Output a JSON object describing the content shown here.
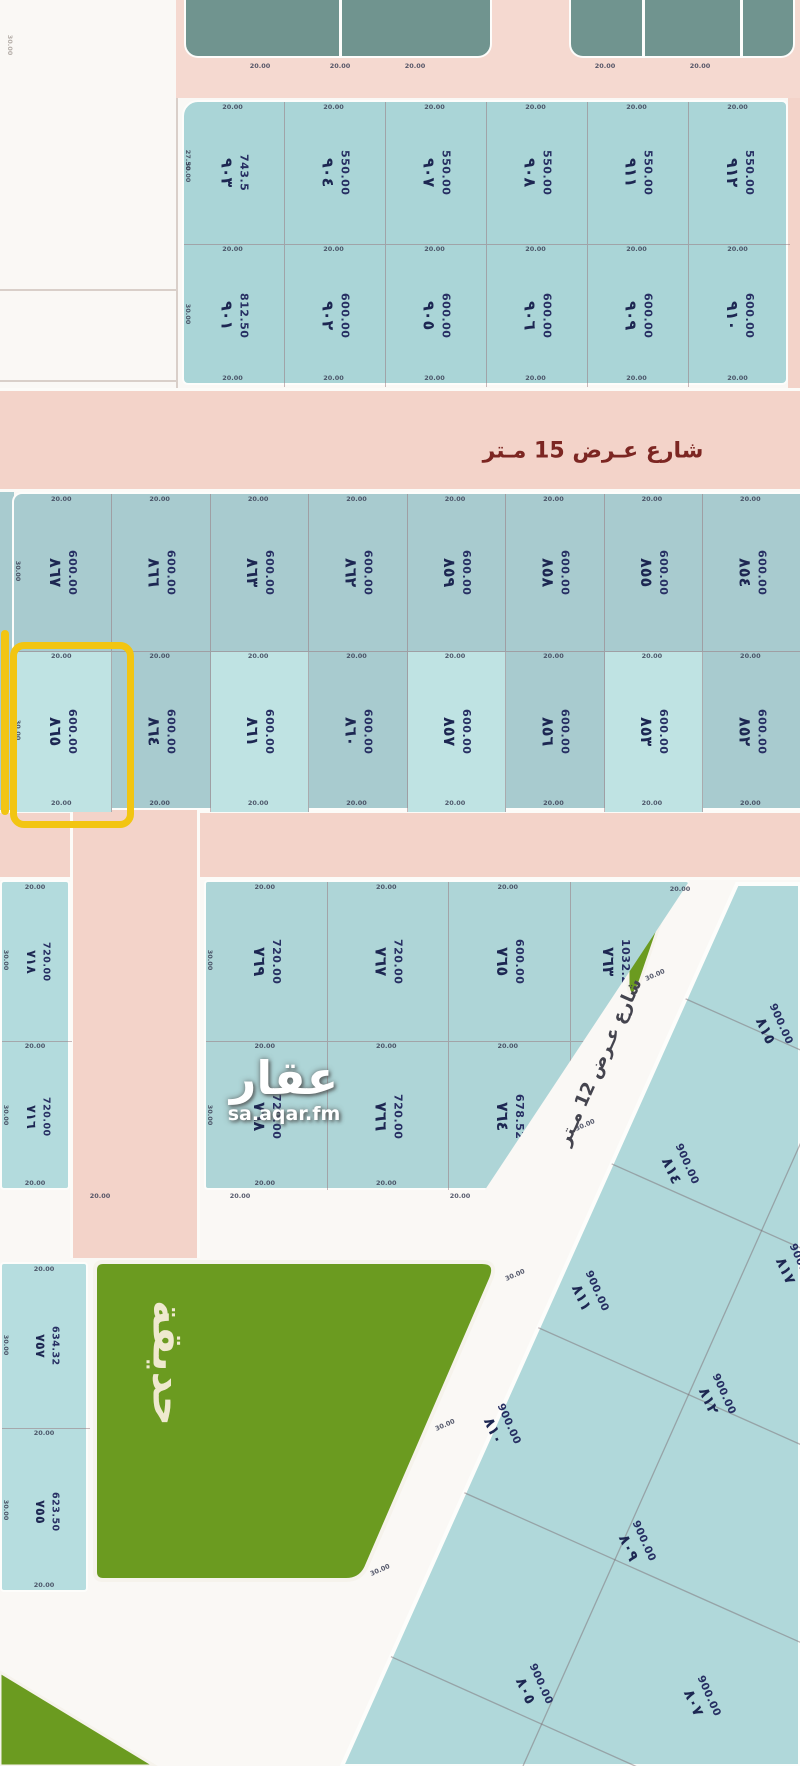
{
  "colors": {
    "road_pink": "#f3d3c9",
    "plot_teal": "#a9ced2",
    "plot_teal_light": "#c0e4e4",
    "dark_block": "#70948f",
    "garden_green": "#6b9b20",
    "number_ink": "#1d2752",
    "street_label_ink": "#7c2622",
    "highlight_yellow": "#f2c512",
    "watermark_white": "#ffffff"
  },
  "streets": {
    "street15_label": "شارع عـرض 15 مـتر",
    "street12_label": "شارع عـرض 12 مـتر"
  },
  "garden": {
    "label": "حديقة"
  },
  "watermark": {
    "logo": "عقار",
    "site": "sa.aqar.fm"
  },
  "dims": {
    "h": "20.00",
    "v": "30.00",
    "v1": "27.50"
  },
  "highlight": {
    "highlighted_plot_number": "٨٦٥"
  },
  "blocks": {
    "north_block_rows": [
      [
        {
          "n": "٩٠٣",
          "a": "743.5"
        },
        {
          "n": "٩٠٤",
          "a": "550.00"
        },
        {
          "n": "٩٠٧",
          "a": "550.00"
        },
        {
          "n": "٩٠٨",
          "a": "550.00"
        },
        {
          "n": "٩١١",
          "a": "550.00"
        },
        {
          "n": "٩١٢",
          "a": "550.00"
        }
      ],
      [
        {
          "n": "٩٠١",
          "a": "812.50"
        },
        {
          "n": "٩٠٢",
          "a": "600.00"
        },
        {
          "n": "٩٠٥",
          "a": "600.00"
        },
        {
          "n": "٩٠٦",
          "a": "600.00"
        },
        {
          "n": "٩٠٩",
          "a": "600.00"
        },
        {
          "n": "٩١٠",
          "a": "600.00"
        }
      ]
    ],
    "mid_block_rows": [
      [
        {
          "n": "٨٦٧",
          "a": "600.00"
        },
        {
          "n": "٨٦٦",
          "a": "600.00"
        },
        {
          "n": "٨٦٣",
          "a": "600.00"
        },
        {
          "n": "٨٦٢",
          "a": "600.00"
        },
        {
          "n": "٨٥٩",
          "a": "600.00"
        },
        {
          "n": "٨٥٨",
          "a": "600.00"
        },
        {
          "n": "٨٥٥",
          "a": "600.00"
        },
        {
          "n": "٨٥٤",
          "a": "600.00"
        },
        {
          "n": "٨٥١",
          "a": "600.00"
        }
      ],
      [
        {
          "n": "٨٦٥",
          "a": "600.00"
        },
        {
          "n": "٨٦٤",
          "a": "600.00"
        },
        {
          "n": "٨٦١",
          "a": "600.00"
        },
        {
          "n": "٨٦٠",
          "a": "600.00"
        },
        {
          "n": "٨٥٧",
          "a": "600.00"
        },
        {
          "n": "٨٥٦",
          "a": "600.00"
        },
        {
          "n": "٨٥٣",
          "a": "600.00"
        },
        {
          "n": "٨٥٢",
          "a": "600.00"
        },
        {
          "n": "٨٤٩",
          "a": "600.00"
        }
      ]
    ],
    "south_block_rows": [
      [
        {
          "n": "٧٦٩",
          "a": "720.00"
        },
        {
          "n": "٧٦٧",
          "a": "720.00"
        },
        {
          "n": "٧٦٥",
          "a": "600.00"
        },
        {
          "n": "٧٦٣",
          "a": "1032.2"
        }
      ],
      [
        {
          "n": "٧٦٨",
          "a": "720.00"
        },
        {
          "n": "٧٦٦",
          "a": "720.00"
        },
        {
          "n": "٧٦٤",
          "a": "678.52"
        },
        {
          "n": "٧٦٢",
          "a": "600.00"
        }
      ]
    ],
    "west_sliver_rows": [
      [
        {
          "n": "٧١٨",
          "a": "720.00"
        }
      ],
      [
        {
          "n": "٧١٦",
          "a": "720.00"
        }
      ]
    ],
    "garden_side_rows": [
      [
        {
          "n": "٧٥٧",
          "a": "634.32"
        }
      ],
      [
        {
          "n": "٧٥٥",
          "a": "623.50"
        }
      ]
    ],
    "diagonal_plots": [
      {
        "n": "٨١٥",
        "a": "900.00",
        "x": 772,
        "y": 1028
      },
      {
        "n": "٨١٤",
        "a": "900.00",
        "x": 678,
        "y": 1168
      },
      {
        "n": "٨١٧",
        "a": "900.00",
        "x": 792,
        "y": 1268
      },
      {
        "n": "٨١١",
        "a": "900.00",
        "x": 588,
        "y": 1295
      },
      {
        "n": "٨١٢",
        "a": "900.00",
        "x": 715,
        "y": 1398
      },
      {
        "n": "٨١٠",
        "a": "900.00",
        "x": 500,
        "y": 1428
      },
      {
        "n": "٨٠٩",
        "a": "900.00",
        "x": 635,
        "y": 1545
      },
      {
        "n": "٨٠٥",
        "a": "900.00",
        "x": 532,
        "y": 1688
      },
      {
        "n": "٨٠٧",
        "a": "900.00",
        "x": 700,
        "y": 1700
      }
    ]
  }
}
